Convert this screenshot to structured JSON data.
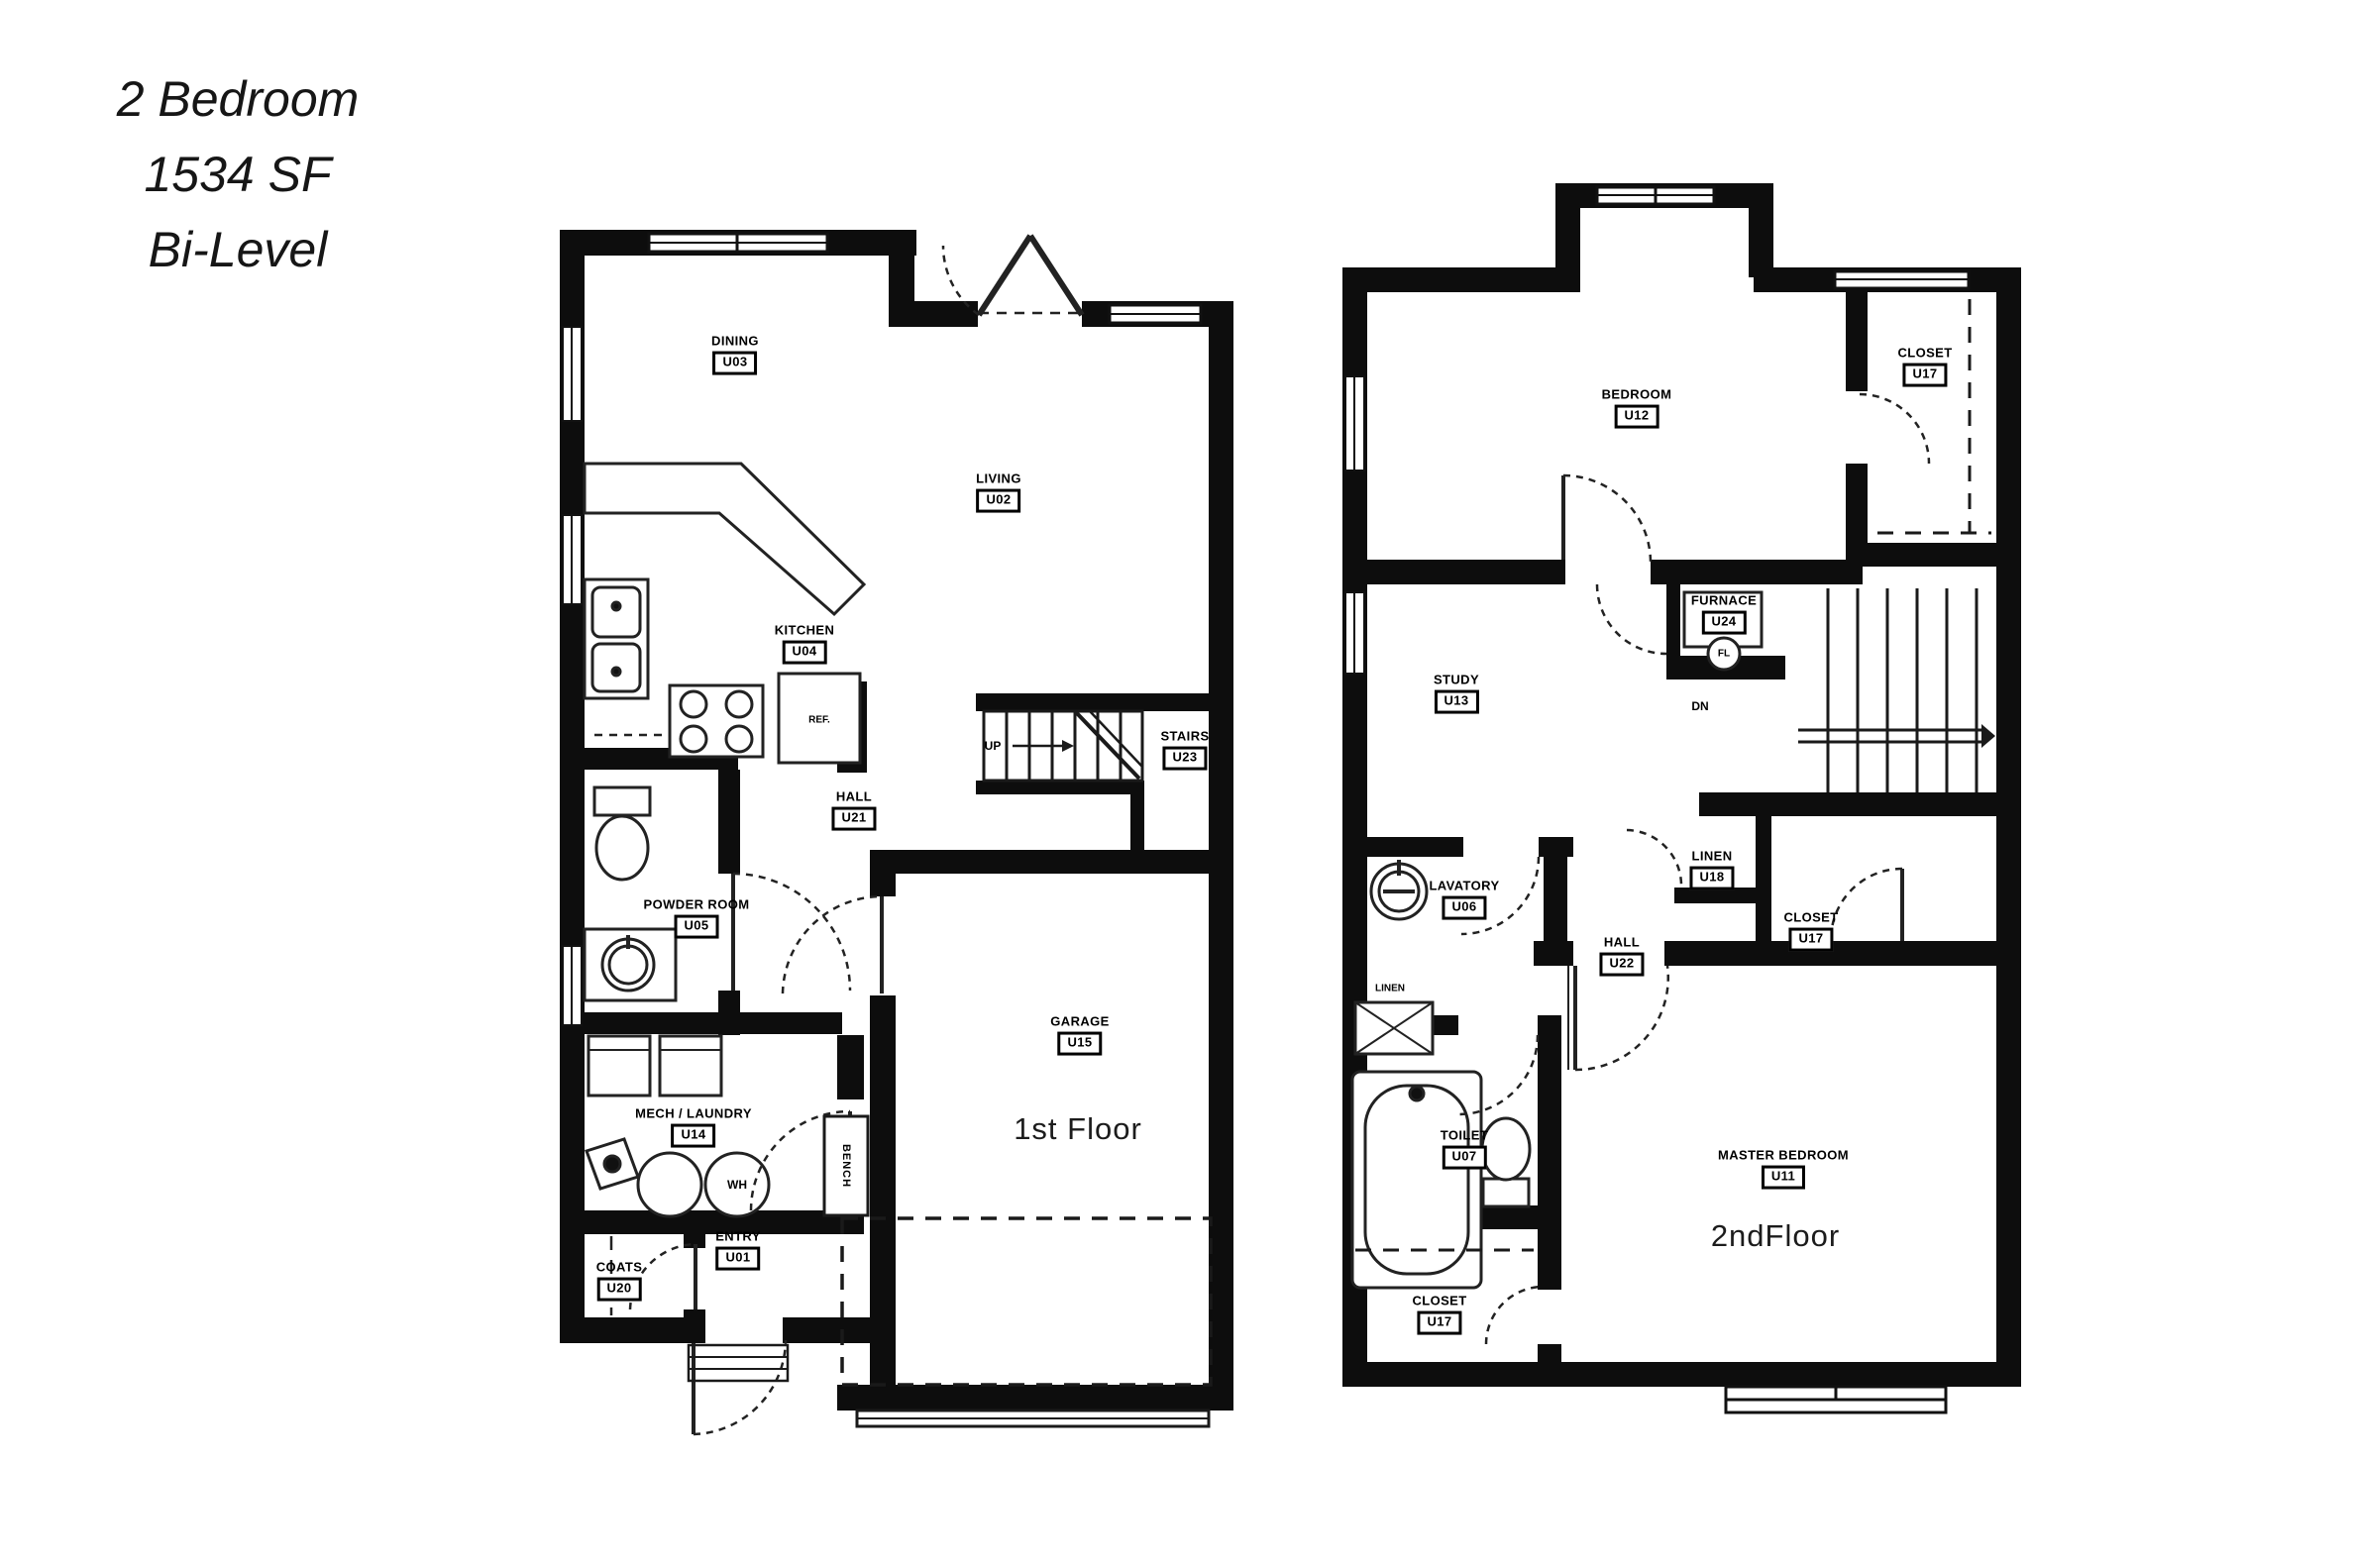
{
  "title": {
    "line1": "2 Bedroom",
    "line2": "1534 SF",
    "line3": "Bi-Level"
  },
  "floor1": {
    "caption": "1st Floor",
    "rooms": {
      "entry": {
        "name": "ENTRY",
        "code": "U01"
      },
      "living": {
        "name": "LIVING",
        "code": "U02"
      },
      "dining": {
        "name": "DINING",
        "code": "U03"
      },
      "kitchen": {
        "name": "KITCHEN",
        "code": "U04"
      },
      "powder": {
        "name": "POWDER ROOM",
        "code": "U05"
      },
      "mech": {
        "name": "MECH / LAUNDRY",
        "code": "U14"
      },
      "garage": {
        "name": "GARAGE",
        "code": "U15"
      },
      "coats": {
        "name": "COATS",
        "code": "U20"
      },
      "hall": {
        "name": "HALL",
        "code": "U21"
      },
      "stairs": {
        "name": "STAIRS",
        "code": "U23"
      }
    },
    "annotations": {
      "up": "UP",
      "ref": "REF.",
      "wh": "WH",
      "bench": "BENCH"
    }
  },
  "floor2": {
    "caption": "2ndFloor",
    "rooms": {
      "lavatory": {
        "name": "LAVATORY",
        "code": "U06"
      },
      "toilet": {
        "name": "TOILET",
        "code": "U07"
      },
      "master": {
        "name": "MASTER BEDROOM",
        "code": "U11"
      },
      "bedroom": {
        "name": "BEDROOM",
        "code": "U12"
      },
      "study": {
        "name": "STUDY",
        "code": "U13"
      },
      "linen": {
        "name": "LINEN",
        "code": "U18"
      },
      "closet_top": {
        "name": "CLOSET",
        "code": "U17"
      },
      "closet_mid": {
        "name": "CLOSET",
        "code": "U17"
      },
      "closet_bottom": {
        "name": "CLOSET",
        "code": "U17"
      },
      "hall": {
        "name": "HALL",
        "code": "U22"
      },
      "furnace": {
        "name": "FURNACE",
        "code": "U24"
      }
    },
    "annotations": {
      "dn": "DN",
      "fl": "FL",
      "linen_small": "LINEN"
    }
  }
}
